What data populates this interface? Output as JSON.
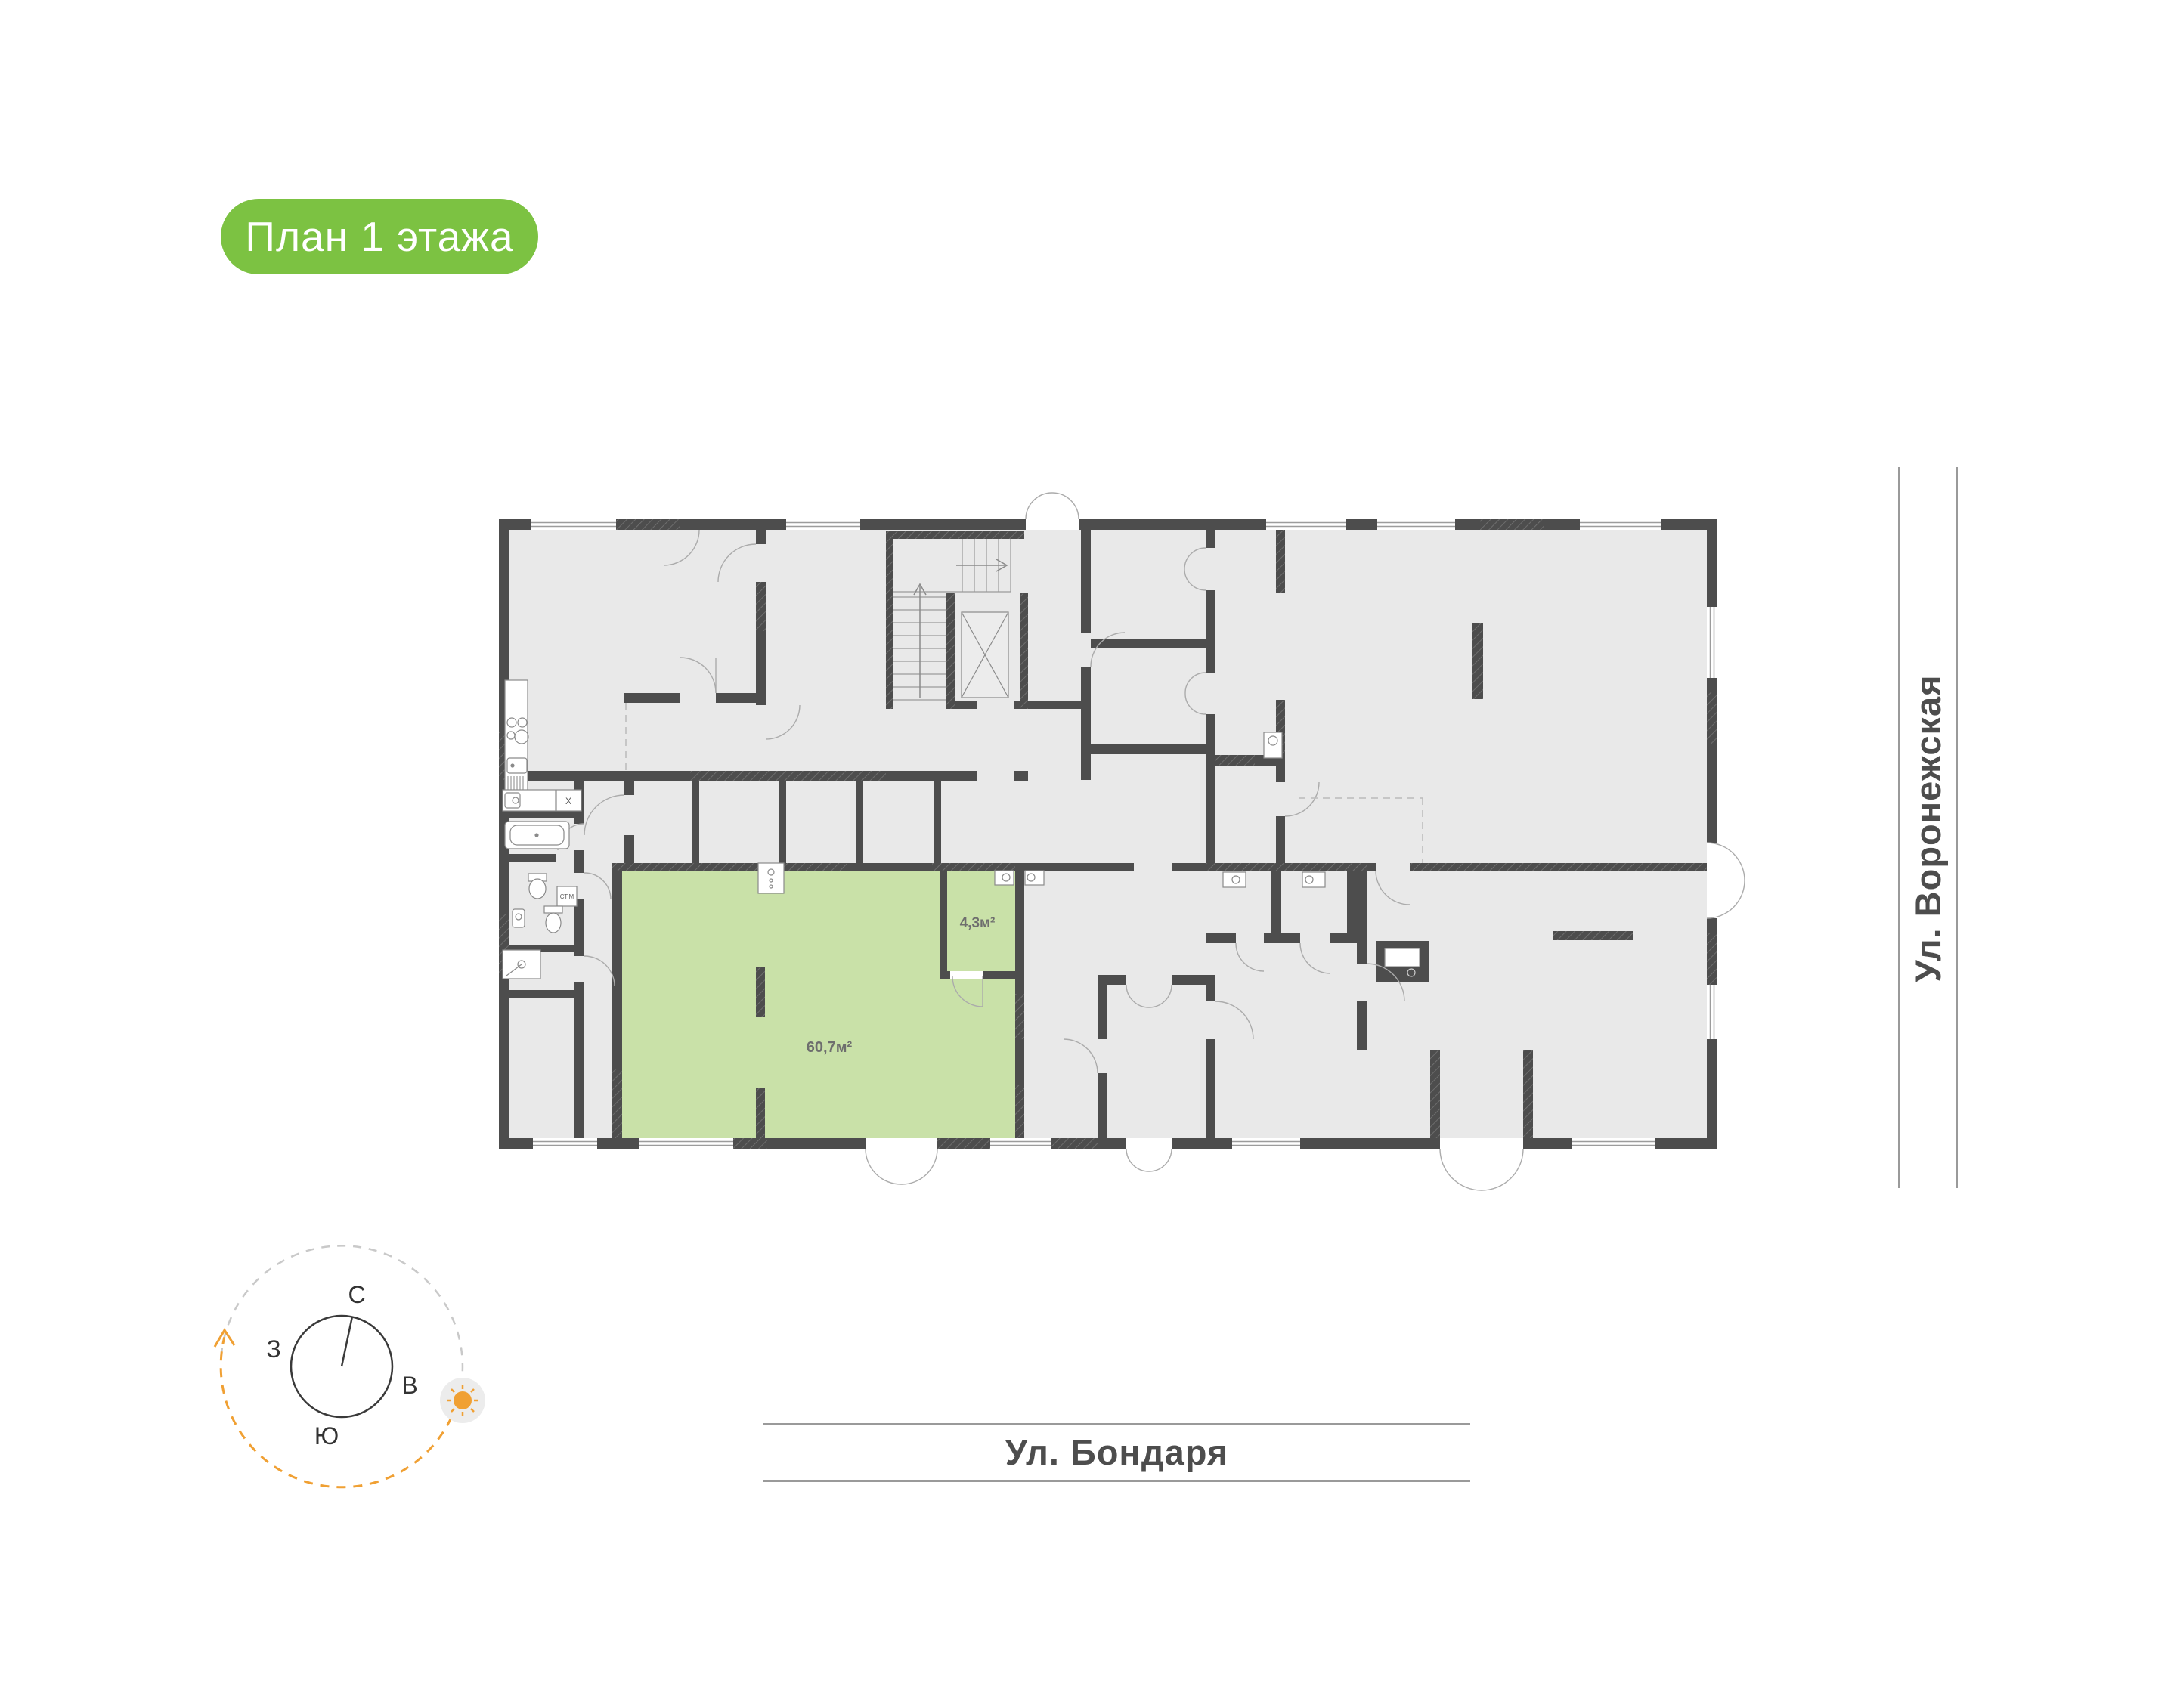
{
  "badge": {
    "label": "План 1 этажа"
  },
  "streets": {
    "right": "Ул. Воронежская",
    "bottom": "Ул. Бондаря"
  },
  "compass": {
    "north": "С",
    "east": "В",
    "south": "Ю",
    "west": "З"
  },
  "plan": {
    "unit": {
      "area": "60,7м²"
    },
    "annex": {
      "area": "4,3м²"
    },
    "labels": {
      "washing_machine": "СТ.М",
      "appliance": "X"
    }
  },
  "colors": {
    "badge_green": "#7cc242",
    "room_green": "#c9e1a8",
    "wall": "#4d4d4d",
    "floor": "#e9e9e9",
    "accent_orange": "#f0a033"
  }
}
